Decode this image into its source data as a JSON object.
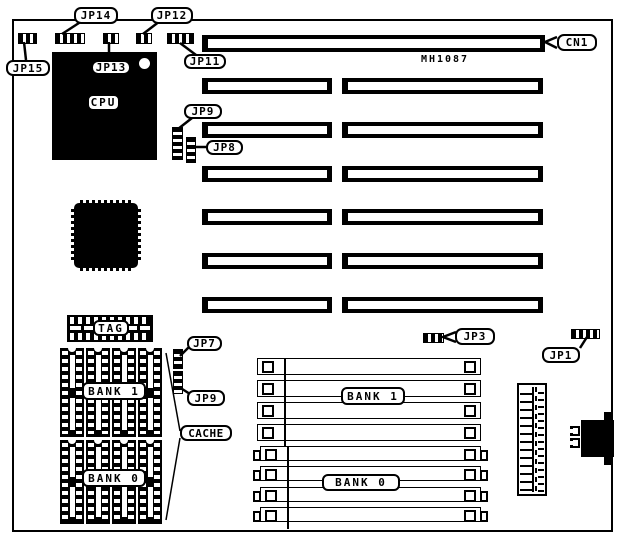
{
  "diagram": {
    "board_model": "MH1087",
    "connectors": {
      "cn1": "CN1"
    },
    "jumpers": {
      "jp1": "JP1",
      "jp3": "JP3",
      "jp7": "JP7",
      "jp8": "JP8",
      "jp9_top": "JP9",
      "jp9_cache": "JP9",
      "jp11": "JP11",
      "jp12": "JP12",
      "jp13": "JP13",
      "jp14": "JP14",
      "jp15": "JP15"
    },
    "components": {
      "cpu": "CPU",
      "tag": "TAG",
      "cache": "CACHE",
      "cache_bank1": "BANK 1",
      "cache_bank0": "BANK 0",
      "simm_bank1": "BANK 1",
      "simm_bank0": "BANK 0"
    },
    "colors": {
      "ink": "#000000",
      "background": "#ffffff"
    }
  }
}
